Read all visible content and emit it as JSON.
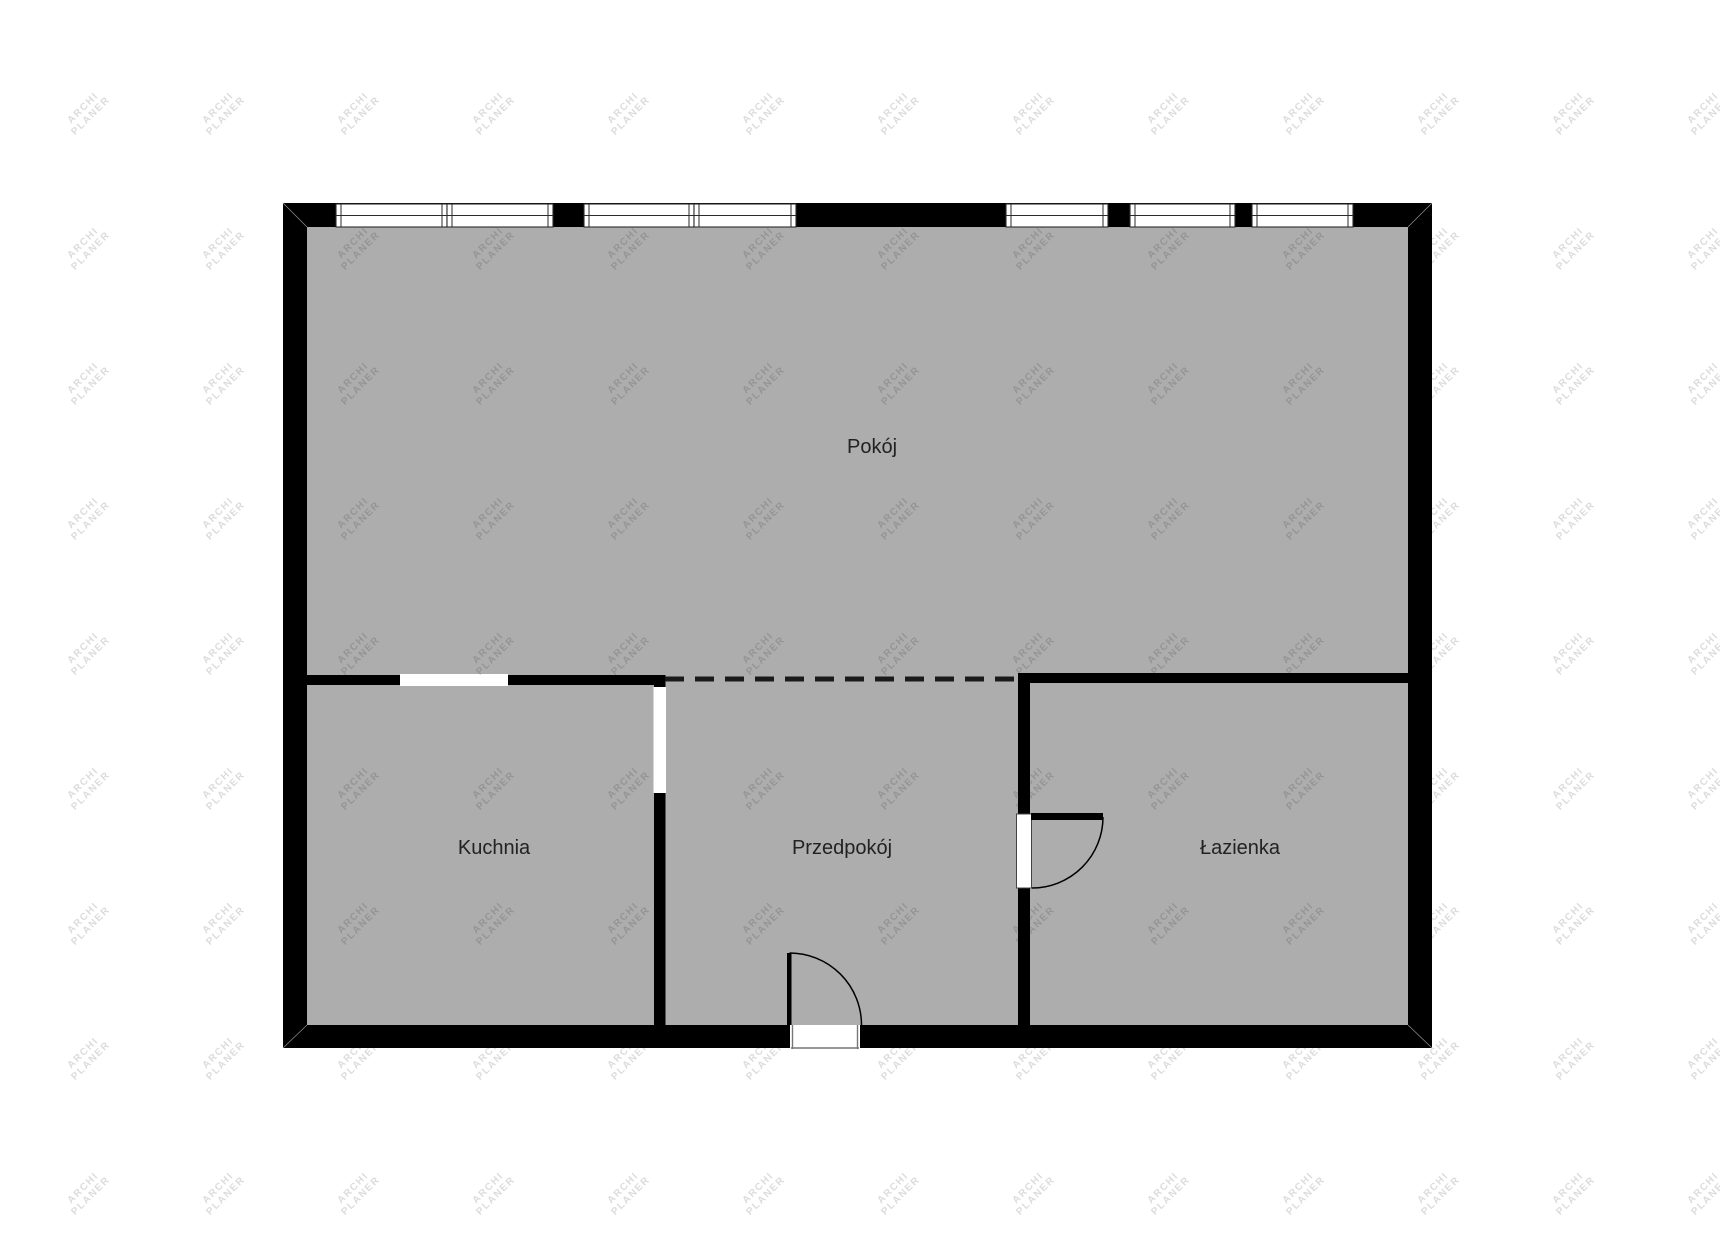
{
  "watermark": {
    "line1": "ARCHI",
    "line2": "PLANER"
  },
  "rooms": [
    {
      "name": "pokoj",
      "label": "Pokój"
    },
    {
      "name": "kuchnia",
      "label": "Kuchnia"
    },
    {
      "name": "przedpokoj",
      "label": "Przedpokój"
    },
    {
      "name": "lazienka",
      "label": "Łazienka"
    }
  ],
  "colors": {
    "background": "#ffffff",
    "floor": "#adadad",
    "wall": "#000000",
    "label": "#222222",
    "watermark": "rgba(0,0,0,0.14)"
  }
}
